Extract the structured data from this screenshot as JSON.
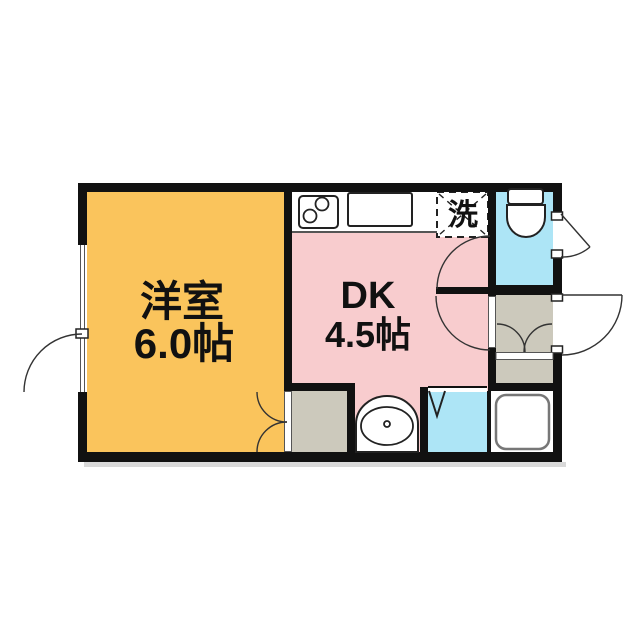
{
  "rooms": {
    "western": {
      "name": "洋室",
      "size": "6.0帖"
    },
    "dk": {
      "name": "DK",
      "size": "4.5帖"
    },
    "laundry": {
      "symbol": "洗"
    }
  },
  "colors": {
    "western_room": "#FAC45C",
    "dk": "#F8CCCE",
    "water": "#ADE5F6",
    "storage": "#CCC9BC",
    "wall": "#111111",
    "background": "#FFFFFF",
    "tub_outline": "#777777",
    "shadow": "#D9D9D9"
  },
  "fixtures": [
    "stove-icon",
    "kitchen-sink-icon",
    "washing-machine-space",
    "toilet-icon",
    "bathtub-icon",
    "washbasin-icon",
    "folding-door",
    "entrance-door",
    "closet-double-doors",
    "casement-window"
  ]
}
